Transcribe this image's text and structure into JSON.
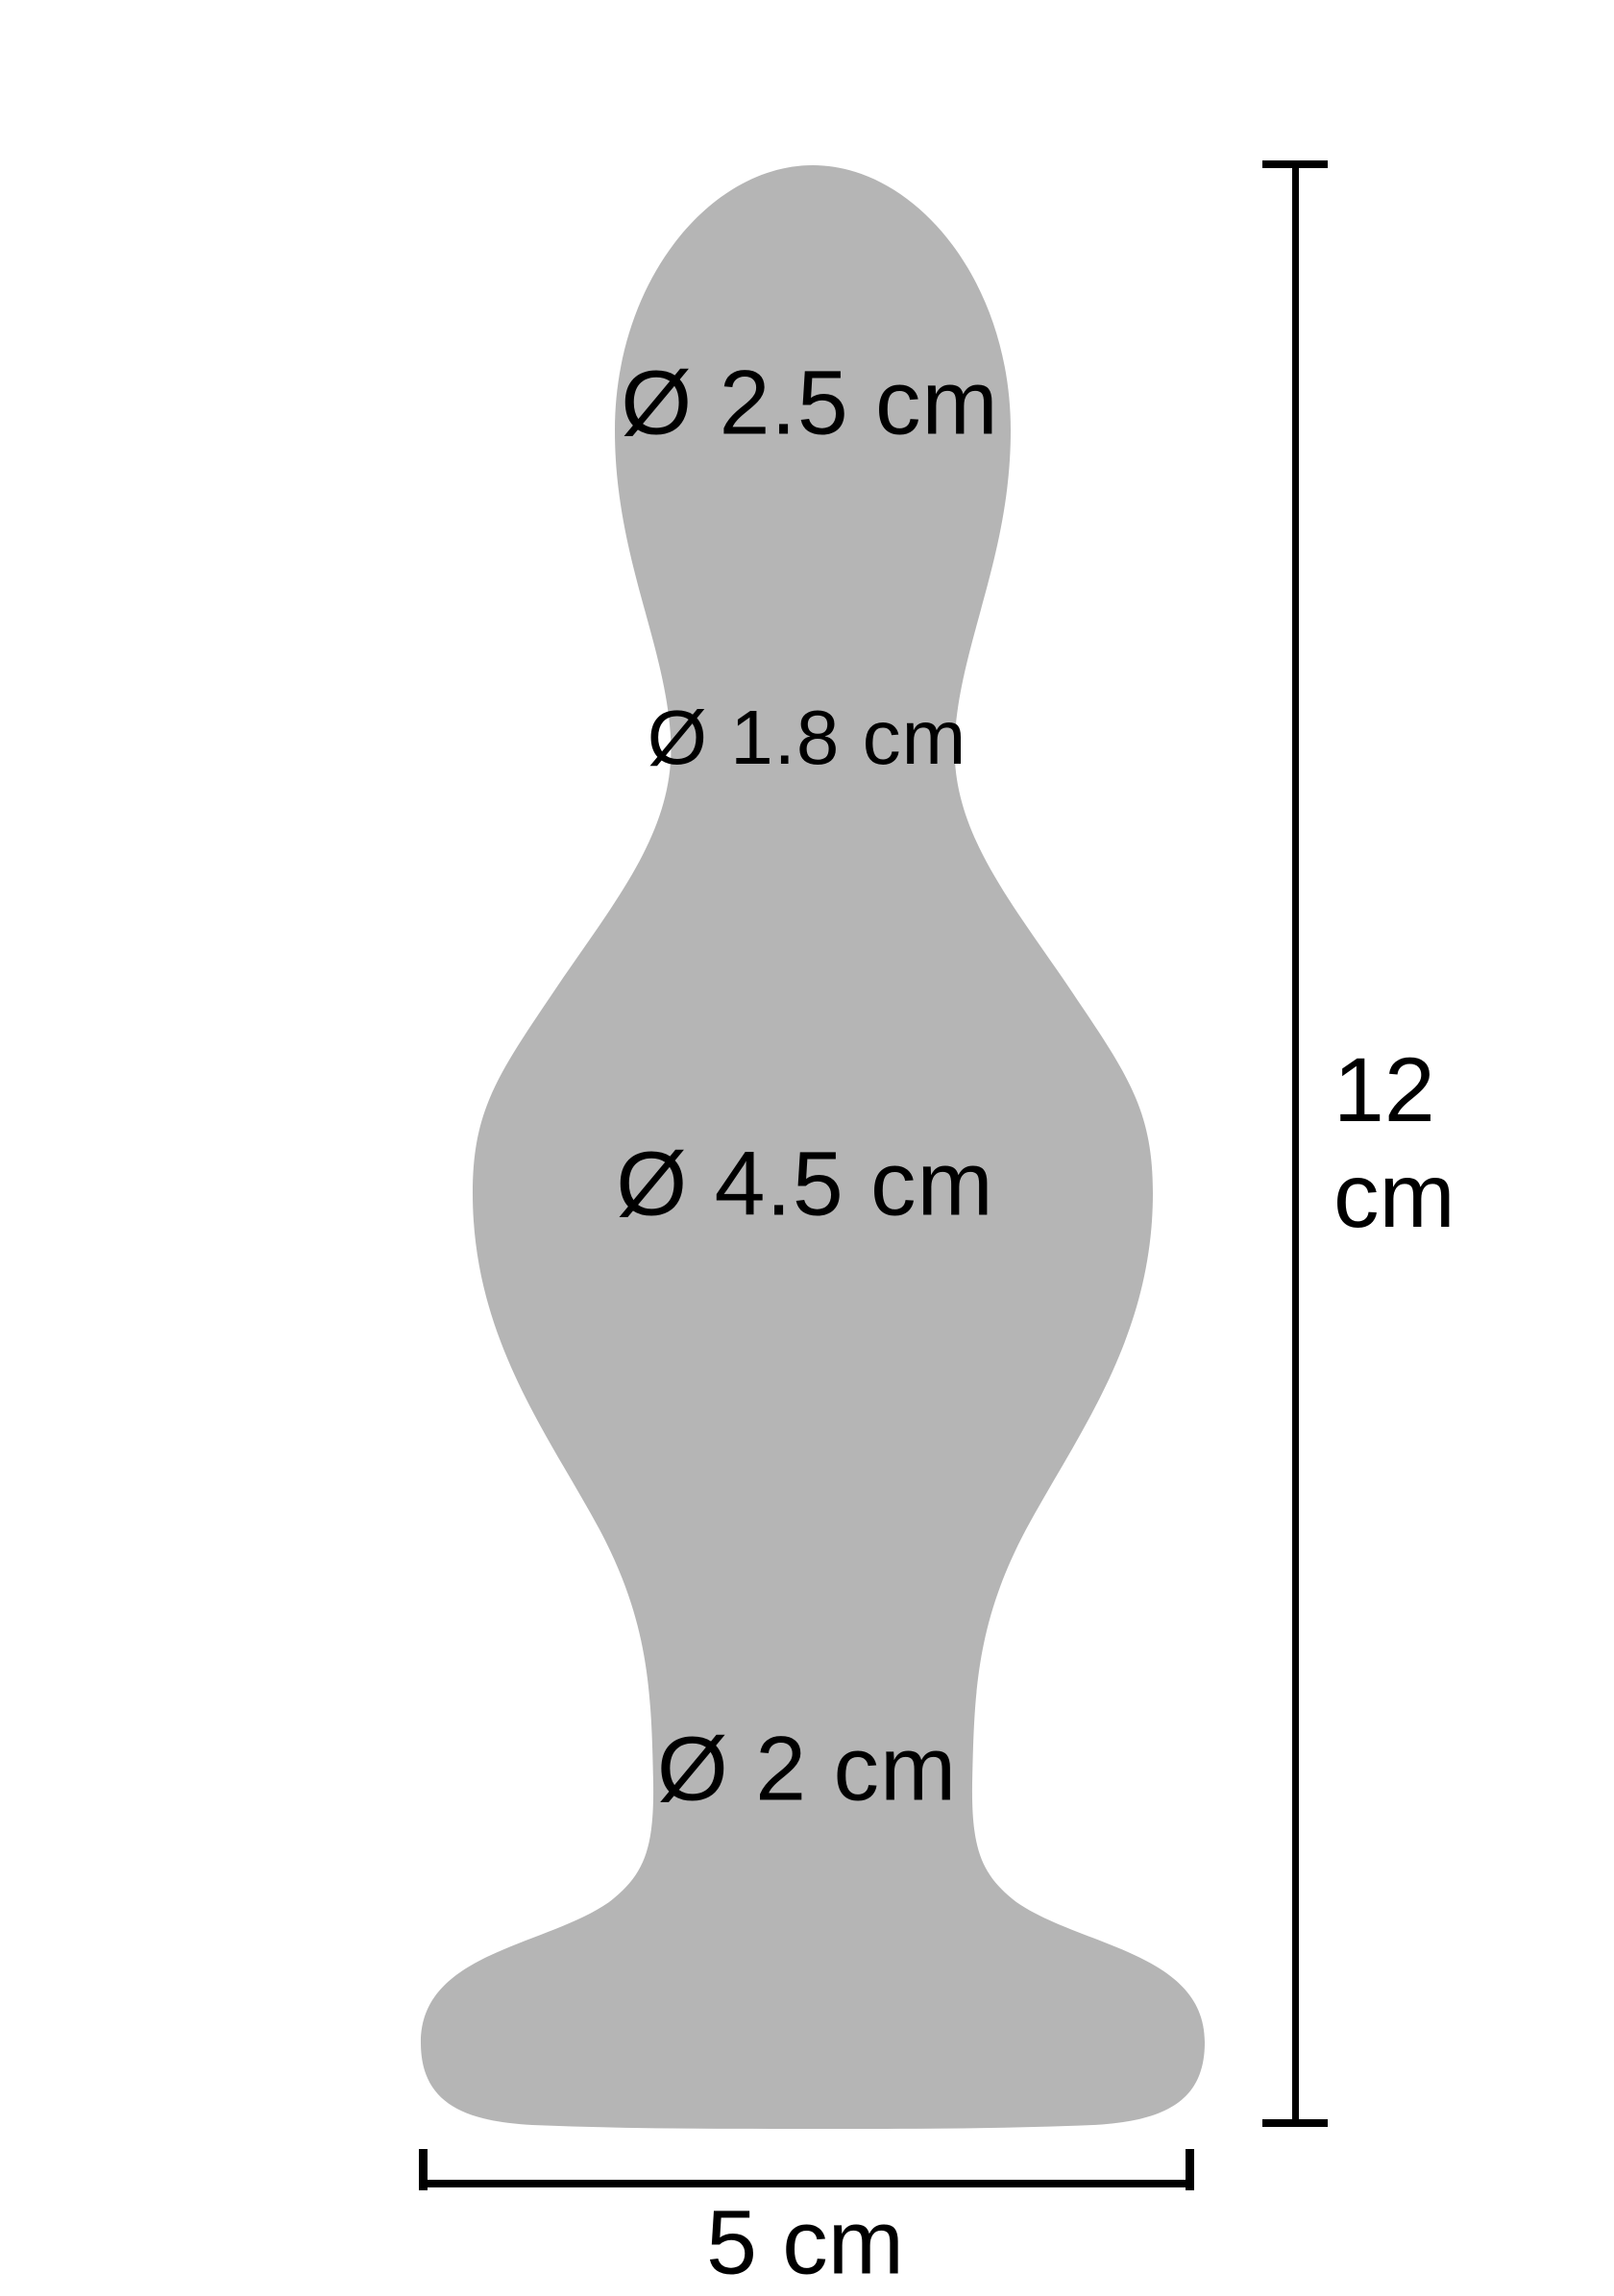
{
  "diagram": {
    "title": "product-dimensions-diagram",
    "colors": {
      "background": "#ffffff",
      "silhouette": "#b5b5b5",
      "dimension_lines": "#000000",
      "text": "#000000"
    },
    "measurements": {
      "top_bulb_diameter": "Ø 2.5 cm",
      "neck_diameter": "Ø 1.8 cm",
      "body_diameter": "Ø 4.5 cm",
      "stem_diameter": "Ø 2 cm"
    },
    "height": {
      "value": "12",
      "unit": "cm"
    },
    "base_width": {
      "label": "5 cm"
    }
  }
}
